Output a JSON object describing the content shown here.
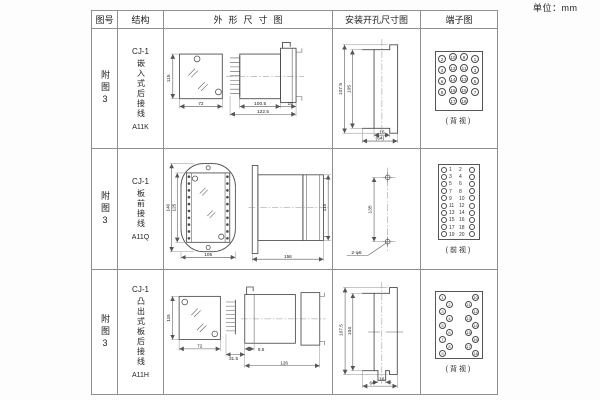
{
  "unit_label": "单位：mm",
  "header": {
    "fig_no": "图号",
    "structure": "结构",
    "outline": "外形尺寸图",
    "mounting": "安装开孔尺寸图",
    "terminal": "端子图"
  },
  "rows": [
    {
      "fig_no": "附图3",
      "structure": {
        "model": "CJ-1",
        "type": "嵌入式后接线",
        "code": "A11K"
      },
      "outline": {
        "height": "115",
        "width": "72",
        "depth_body": "100.5",
        "depth_total": "122.5",
        "flange_depth": "15"
      },
      "mounting": {
        "outer_height": "107.5",
        "inner_height": "105",
        "slot_width": "16",
        "overall_width": "(64)"
      },
      "terminal": {
        "view_label": "(背视)",
        "pattern": "grid",
        "rows": [
          [
            "2",
            "10",
            "9",
            "1"
          ],
          [
            "4",
            "12",
            "11",
            "3"
          ],
          [
            "6",
            "14",
            "13",
            "5"
          ],
          [
            "8",
            "16",
            "15",
            "7"
          ],
          [
            "17",
            "18"
          ]
        ]
      }
    },
    {
      "fig_no": "附图3",
      "structure": {
        "model": "CJ-1",
        "type": "板前接线",
        "code": "A11Q"
      },
      "outline": {
        "outer_height": "140",
        "inner_height": "125",
        "width": "105",
        "depth": "156",
        "height": "115"
      },
      "mounting": {
        "hole_spacing": "135",
        "hole_note": "2-φ6"
      },
      "terminal": {
        "view_label": "(前视)",
        "pattern": "cols",
        "left": [
          "1",
          "3",
          "5",
          "7",
          "9",
          "11",
          "13",
          "15",
          "17",
          "19"
        ],
        "right": [
          "2",
          "4",
          "6",
          "8",
          "10",
          "12",
          "14",
          "16",
          "18",
          "20"
        ]
      }
    },
    {
      "fig_no": "附图3",
      "structure": {
        "model": "CJ-1",
        "type": "凸出式板后接线",
        "code": "A11H"
      },
      "outline": {
        "height": "115",
        "width": "72",
        "pin_length": "31.5",
        "collar": "9.5",
        "depth": "126"
      },
      "mounting": {
        "outer_height": "107.5",
        "inner_height": "104",
        "slot_width": "16",
        "overall_width": "64"
      },
      "terminal": {
        "view_label": "(背视)",
        "pattern": "zigzag",
        "count": 18
      }
    }
  ]
}
